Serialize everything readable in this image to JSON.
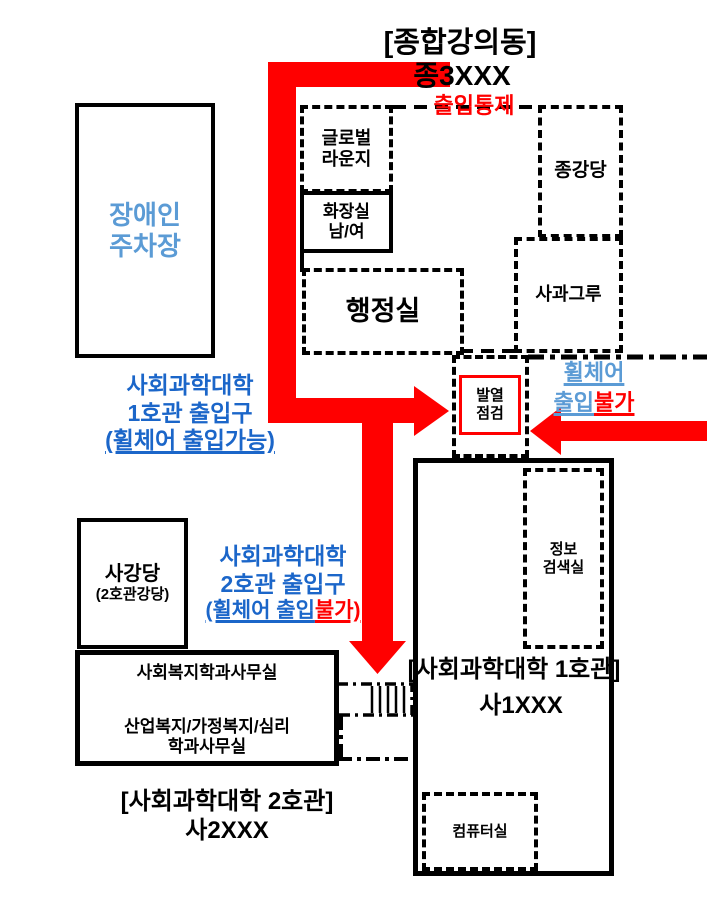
{
  "colors": {
    "arrow_red": "#ff0000",
    "dark_blue": "#1b66c9",
    "light_blue": "#5b9bd5",
    "outline_black": "#000000"
  },
  "title": {
    "name": "[종합강의동]",
    "code": "종3XXX",
    "access_control": "출입통제"
  },
  "lecture_building": {
    "rooms": {
      "global_lounge": {
        "line1": "글로벌",
        "line2": "라운지"
      },
      "toilet": {
        "line1": "화장실",
        "line2": "남/여"
      },
      "auditorium": {
        "label": "종강당"
      },
      "sagwageuru": {
        "label": "사과그루"
      },
      "admin_office": {
        "label": "행정실"
      }
    }
  },
  "fever_check": {
    "line1": "발열",
    "line2": "점검"
  },
  "parking": {
    "line1": "장애인",
    "line2": "주차장"
  },
  "entrance1": {
    "line1": "사회과학대학",
    "line2": "1호관 출입구",
    "line3": "(휠체어 출입가능)"
  },
  "entrance2": {
    "line1": "사회과학대학",
    "line2": "2호관 출입구",
    "line3_blue": "(휠체어 출입",
    "line3_red": "불가)"
  },
  "wheelchair_no": {
    "line1": "휠체어",
    "line2_blue": "출입",
    "line2_red": "불가"
  },
  "building1": {
    "name": "[사회과학대학 1호관]",
    "code": "사1XXX",
    "rooms": {
      "info_room": {
        "line1": "정보",
        "line2": "검색실"
      },
      "computer_room": {
        "label": "컴퓨터실"
      }
    }
  },
  "building2": {
    "name": "[사회과학대학 2호관]",
    "code": "사2XXX",
    "rooms": {
      "sagangdang": {
        "line1": "사강당",
        "line2": "(2호관강당)"
      },
      "offices": {
        "line1": "사회복지학과사무실",
        "line2": "산업복지/가정복지/심리",
        "line3": "학과사무실"
      }
    }
  }
}
